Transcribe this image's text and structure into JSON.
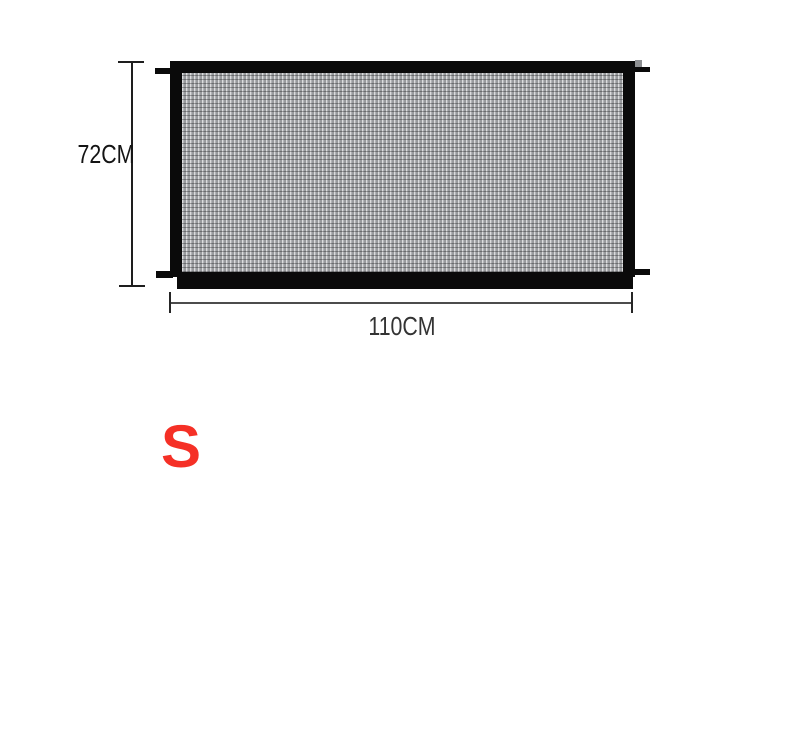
{
  "page": {
    "background_color": "#ffffff"
  },
  "product_diagram": {
    "name": "mesh safety gate dimension drawing",
    "frame_color": "#0a0a0a",
    "mesh_base_color": "#a3a5a8",
    "dimension_line_color": "#1e1e1e",
    "height_dimension": {
      "label": "72CM"
    },
    "width_dimension": {
      "label": "110CM"
    }
  },
  "size_option": {
    "label": "S",
    "color": "#f53026"
  }
}
